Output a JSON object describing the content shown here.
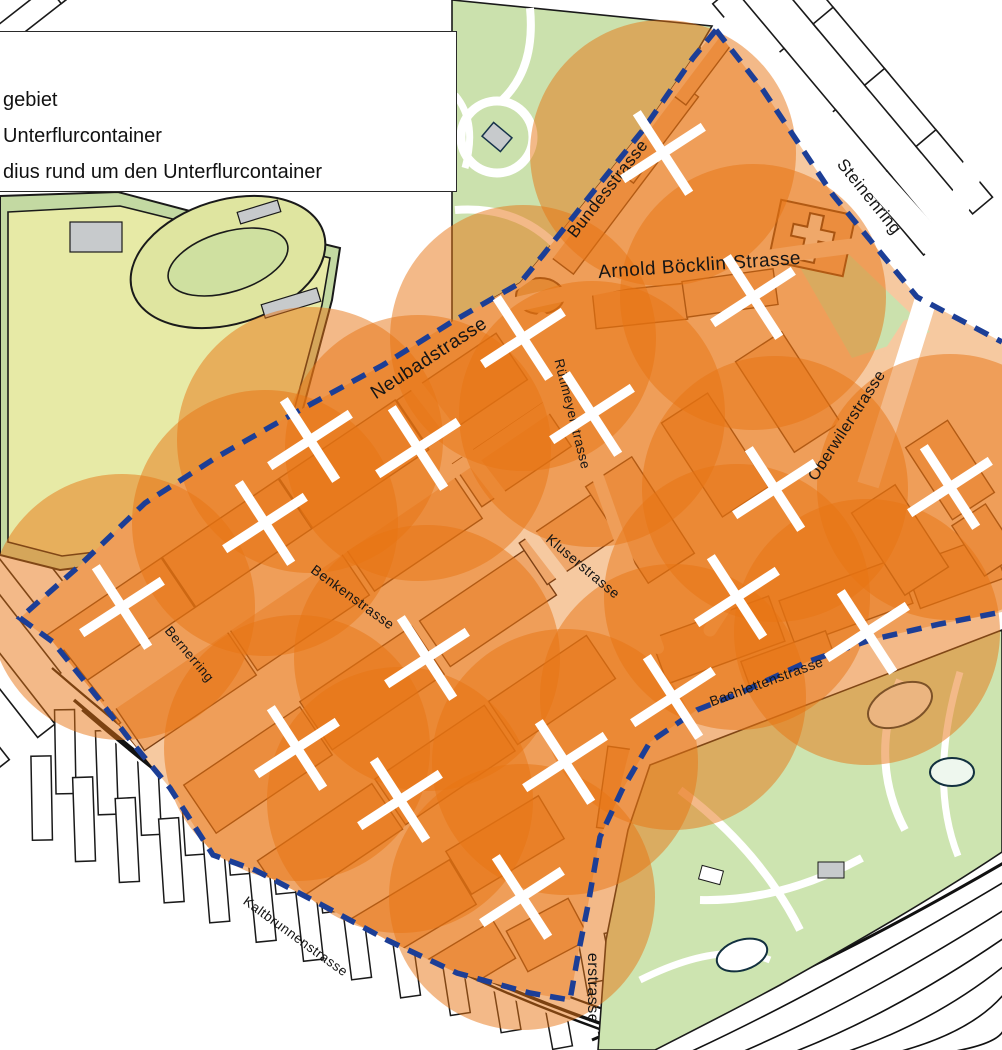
{
  "legend": {
    "lines": [
      "gebiet",
      "Unterflurcontainer",
      "dius rund um den Unterflurcontainer"
    ]
  },
  "map": {
    "radius_px": 133,
    "colors": {
      "circle_orange": "#e87412",
      "area_ground": "#f6c9a0",
      "building_fill": "#efa76b",
      "building_stroke": "#7d4014",
      "boundary_blue": "#1c3e96",
      "park_green": "#cbe1ad",
      "field_yellow": "#e7eaa6",
      "field_band": "#c3d9a2",
      "zoo_green": "#cde4b0",
      "gray": "#c7cacc",
      "marker_white": "#ffffff",
      "outline_black": "#1a1a1a"
    },
    "streets": [
      {
        "name": "Bundesstrasse",
        "x": 612,
        "y": 192,
        "rot": -52,
        "size": 17
      },
      {
        "name": "Steinenring",
        "x": 865,
        "y": 200,
        "rot": 51,
        "size": 17
      },
      {
        "name": "Arnold Böcklin-Strasse",
        "x": 700,
        "y": 271,
        "rot": -4,
        "size": 19
      },
      {
        "name": "Neubadstrasse",
        "x": 432,
        "y": 363,
        "rot": -33,
        "size": 19
      },
      {
        "name": "Rütimeyerstrasse",
        "x": 568,
        "y": 415,
        "rot": 76,
        "size": 13.5
      },
      {
        "name": "Kluserstrasse",
        "x": 580,
        "y": 570,
        "rot": 40,
        "size": 14
      },
      {
        "name": "Oberwilerstrasse",
        "x": 851,
        "y": 428,
        "rot": -57,
        "size": 16
      },
      {
        "name": "Benkenstrasse",
        "x": 350,
        "y": 601,
        "rot": 36,
        "size": 14
      },
      {
        "name": "Bernerring",
        "x": 186,
        "y": 657,
        "rot": 50,
        "size": 13.5
      },
      {
        "name": "Bachlettenstrasse",
        "x": 768,
        "y": 686,
        "rot": -20,
        "size": 14
      },
      {
        "name": "Kaltbrunnenstrasse",
        "x": 293,
        "y": 940,
        "rot": 36,
        "size": 13.5
      },
      {
        "name": "erstrasse",
        "x": 588,
        "y": 988,
        "rot": 90,
        "size": 16
      }
    ],
    "containers": [
      {
        "x": 663,
        "y": 153
      },
      {
        "x": 753,
        "y": 297
      },
      {
        "x": 523,
        "y": 338
      },
      {
        "x": 592,
        "y": 414
      },
      {
        "x": 310,
        "y": 440
      },
      {
        "x": 418,
        "y": 448
      },
      {
        "x": 265,
        "y": 523
      },
      {
        "x": 775,
        "y": 489
      },
      {
        "x": 950,
        "y": 487
      },
      {
        "x": 122,
        "y": 607
      },
      {
        "x": 427,
        "y": 658
      },
      {
        "x": 867,
        "y": 632
      },
      {
        "x": 297,
        "y": 748
      },
      {
        "x": 565,
        "y": 762
      },
      {
        "x": 400,
        "y": 800
      },
      {
        "x": 673,
        "y": 697
      },
      {
        "x": 522,
        "y": 897
      },
      {
        "x": 737,
        "y": 597
      }
    ]
  }
}
